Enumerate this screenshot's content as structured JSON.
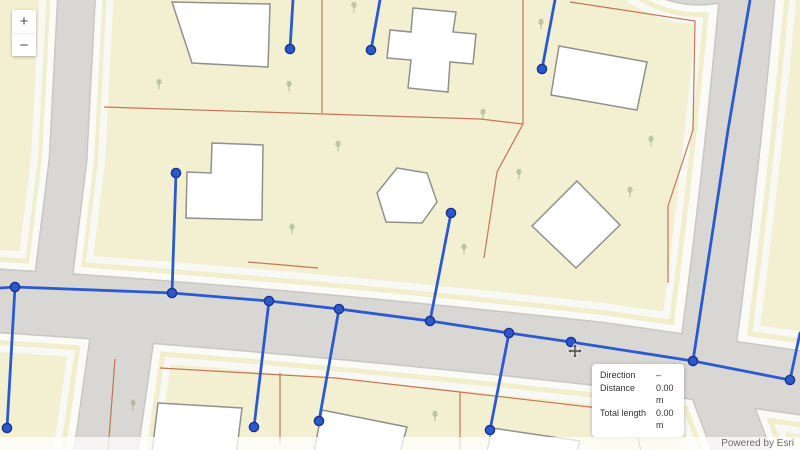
{
  "zoom_control": {
    "zoom_in": "+",
    "zoom_out": "−"
  },
  "measurement_panel": {
    "rows": [
      {
        "label": "Direction",
        "value": "–"
      },
      {
        "label": "Distance",
        "value": "0.00 m"
      },
      {
        "label": "Total length",
        "value": "0.00 m"
      }
    ]
  },
  "attribution": {
    "text": "Powered by Esri"
  },
  "colors": {
    "parcel_fill": "#f3f0d2",
    "road_gray": "#d9d7d4",
    "road_curb": "#c9c7c3",
    "sidewalk_white": "#fafaf7",
    "parcel_boundary_red": "#c0603c",
    "building_fill": "#ffffff",
    "building_stroke": "#90908e",
    "network_line": "#2a5ad2",
    "network_node_fill": "#2a58cf",
    "network_node_stroke": "#17338c",
    "tree_green": "#9dab82",
    "tooltip_text": "#323232",
    "attribution_text": "#6e6e6e"
  },
  "network": {
    "edges": [
      [
        [
          0,
          288
        ],
        [
          15,
          287
        ],
        [
          172,
          293
        ],
        [
          269,
          301
        ],
        [
          339,
          309
        ],
        [
          430,
          321
        ],
        [
          509,
          333
        ],
        [
          571,
          342
        ],
        [
          693,
          361
        ],
        [
          790,
          380
        ]
      ],
      [
        [
          15,
          287
        ],
        [
          7,
          428
        ]
      ],
      [
        [
          172,
          293
        ],
        [
          176,
          173
        ]
      ],
      [
        [
          269,
          301
        ],
        [
          254,
          427
        ]
      ],
      [
        [
          339,
          309
        ],
        [
          319,
          421
        ]
      ],
      [
        [
          430,
          321
        ],
        [
          451,
          213
        ]
      ],
      [
        [
          509,
          333
        ],
        [
          490,
          430
        ]
      ],
      [
        [
          693,
          361
        ],
        [
          728,
          130
        ],
        [
          750,
          0
        ]
      ],
      [
        [
          790,
          380
        ],
        [
          800,
          333
        ]
      ],
      [
        [
          293,
          0
        ],
        [
          290,
          49
        ]
      ],
      [
        [
          380,
          0
        ],
        [
          371,
          50
        ]
      ],
      [
        [
          555,
          0
        ],
        [
          542,
          69
        ]
      ]
    ],
    "nodes": [
      [
        15,
        287
      ],
      [
        172,
        293
      ],
      [
        269,
        301
      ],
      [
        339,
        309
      ],
      [
        430,
        321
      ],
      [
        509,
        333
      ],
      [
        571,
        342
      ],
      [
        693,
        361
      ],
      [
        790,
        380
      ],
      [
        7,
        428
      ],
      [
        176,
        173
      ],
      [
        254,
        427
      ],
      [
        319,
        421
      ],
      [
        451,
        213
      ],
      [
        490,
        430
      ],
      [
        290,
        49
      ],
      [
        371,
        50
      ],
      [
        542,
        69
      ]
    ]
  }
}
